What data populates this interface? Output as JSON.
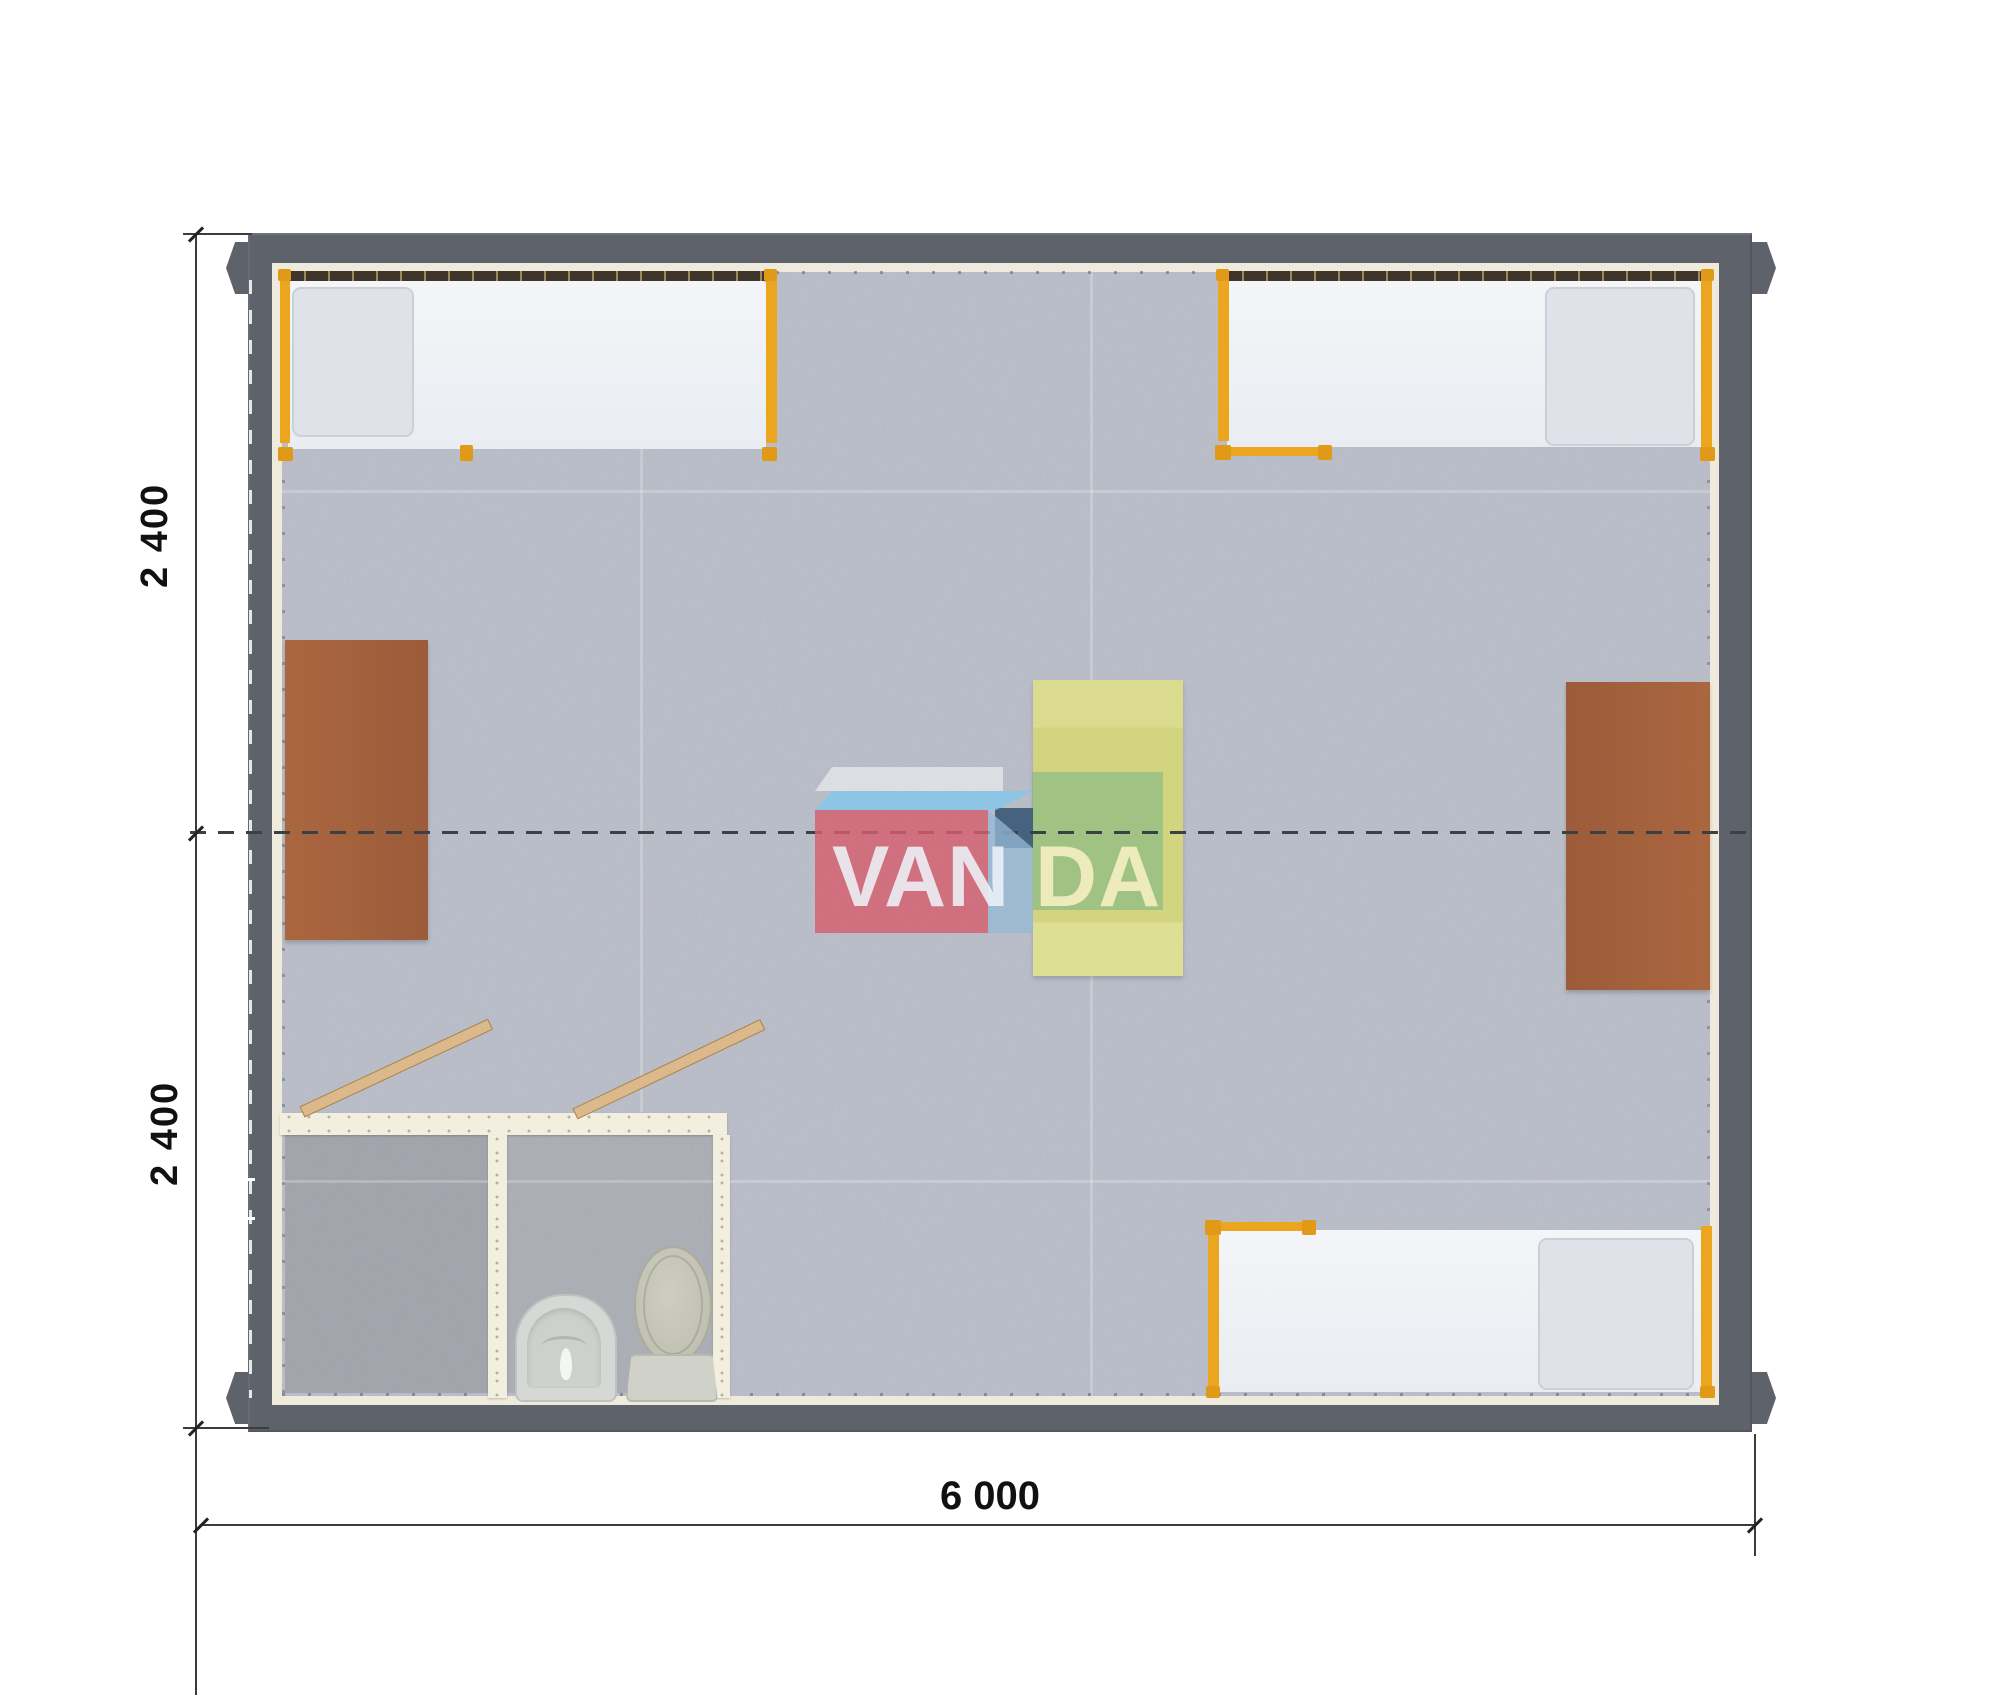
{
  "page": {
    "background_color": "#ffffff",
    "description": "Top-down 3D rendered floor plan of a 6.0 x 4.8 m two-module building with three beds, two desks, a centre table and a bathroom block"
  },
  "dimensions": {
    "left_top_label": "2 400",
    "left_bottom_label": "2 400",
    "bottom_label": "6 000"
  },
  "watermark": {
    "name": "VANDA logo",
    "text_left": "VAN",
    "text_right": "DA"
  },
  "colors": {
    "wall": "#5e636b",
    "wall_lining": "#efebdc",
    "carpet": "#b9bdc8",
    "bathroom_floor": "#a6a9b0",
    "bed_frame_orange": "#eba51f",
    "bed_head_rail": "#3f352a",
    "mattress": "#eef1f5",
    "pillow": "#dfe3e9",
    "desk_brown": "#a5613c",
    "table_yellow": "#d6d789",
    "door_leaf": "#dcb98b",
    "logo_red": "#d55f6e",
    "logo_blue_top": "#82c8eb",
    "logo_navy": "#3c5a78",
    "logo_green": "#7cb585",
    "dimension_text": "#111111"
  },
  "elements": {
    "beds": [
      "bed-top-left",
      "bed-top-right",
      "bed-bottom-right"
    ],
    "desks": [
      "desk-left",
      "desk-right"
    ],
    "table": "table-center",
    "bathroom": {
      "rooms": 2,
      "fixtures": [
        "sink",
        "toilet"
      ],
      "doors": 2
    }
  }
}
